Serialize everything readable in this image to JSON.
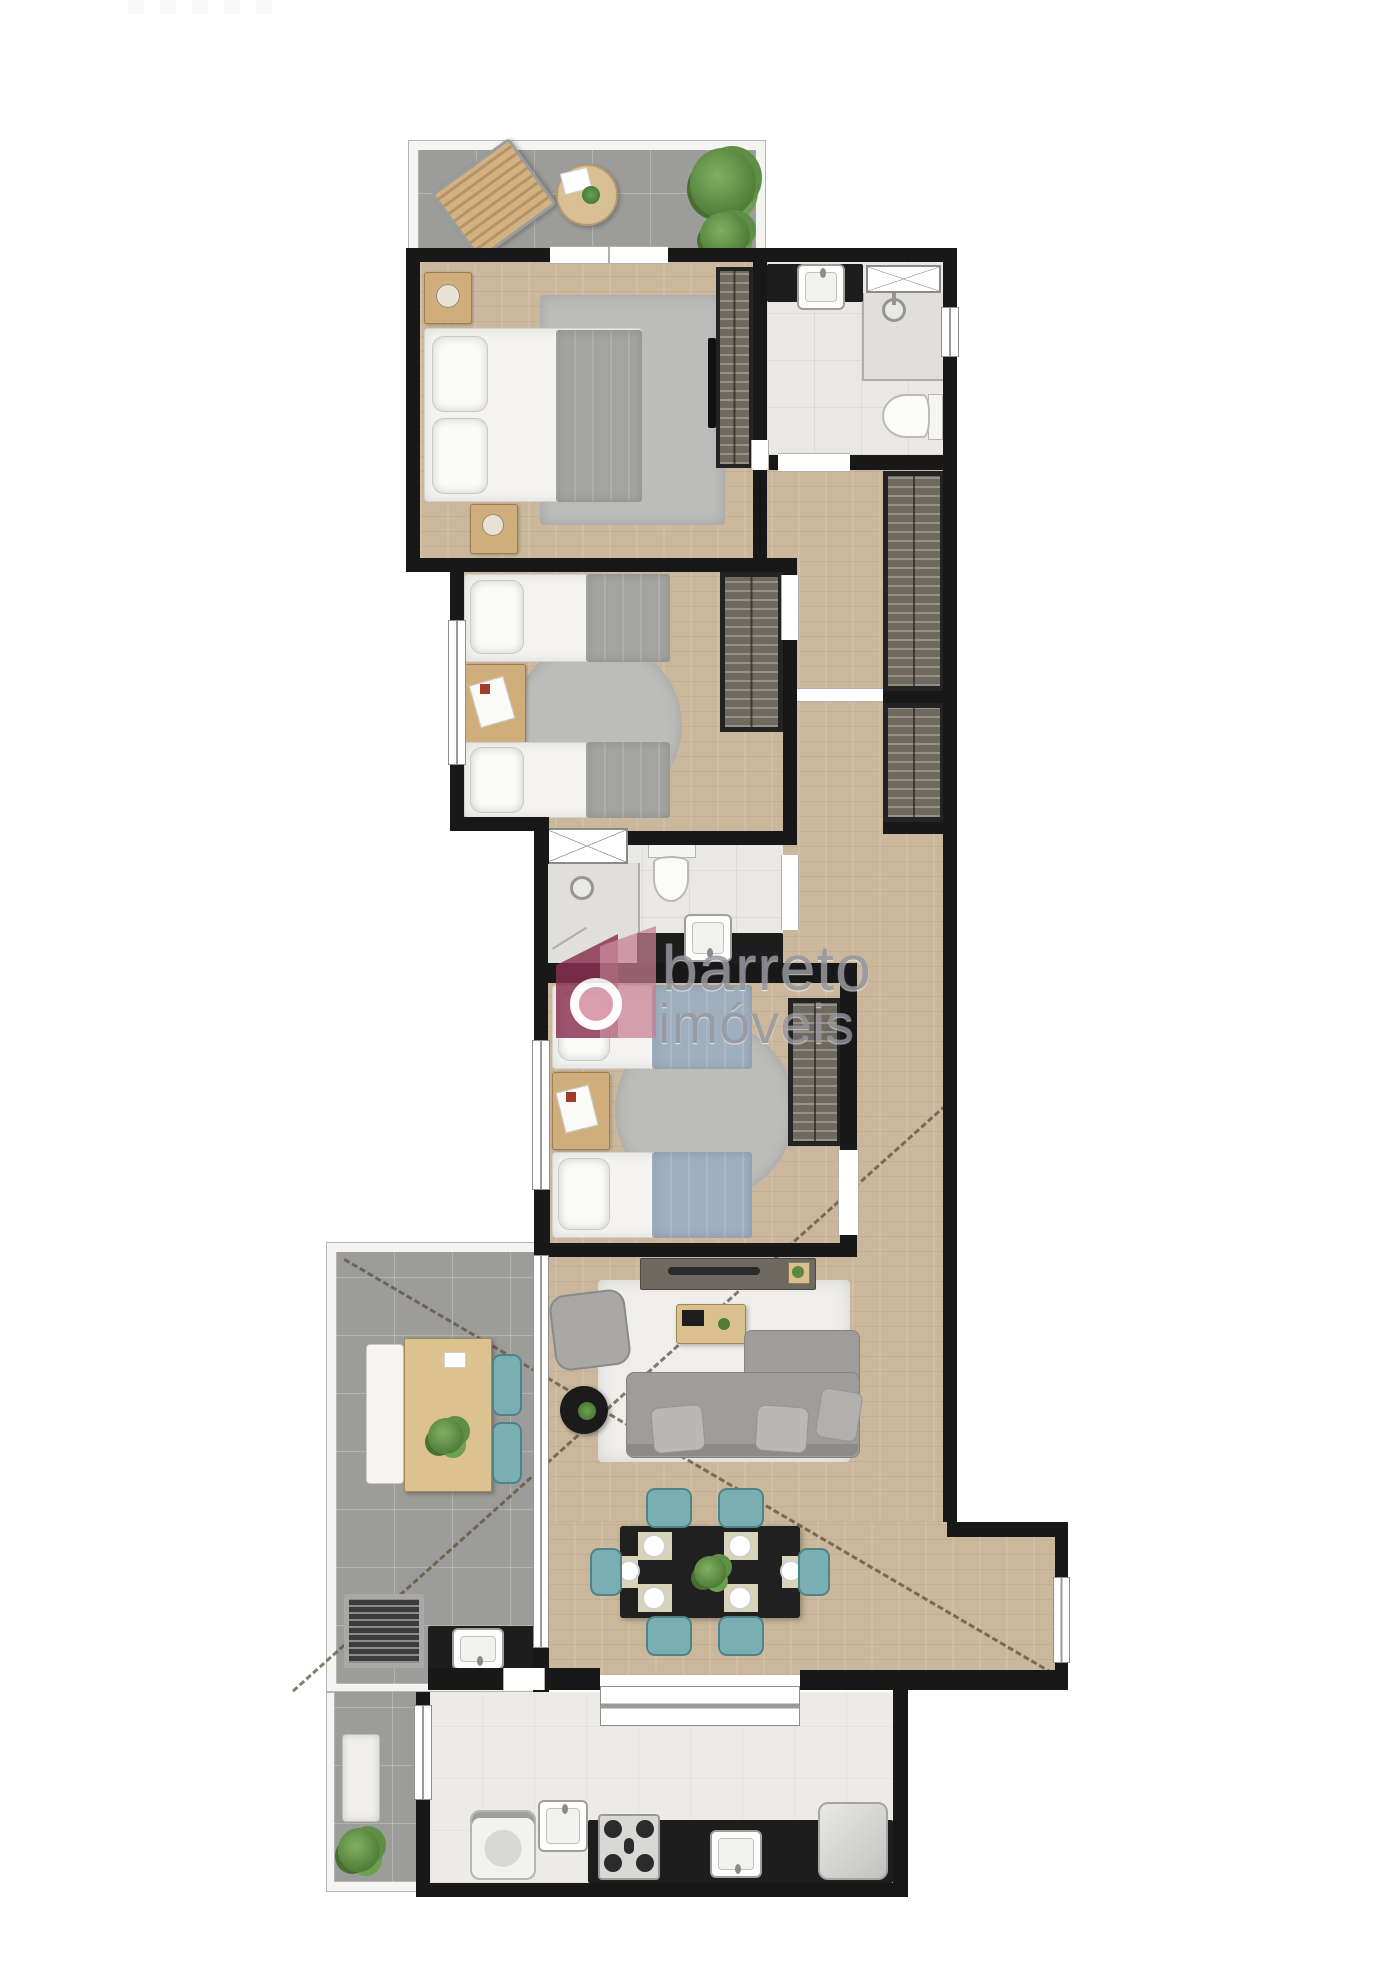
{
  "watermark": {
    "line1": "barreto",
    "line2": "imóveis"
  },
  "colors": {
    "wall": "#181818",
    "wood": "#cbb89c",
    "tile_gray": "#9c9c9a",
    "tile_bath": "#e9e8e4",
    "tile_kitchen": "#edebe7",
    "counter": "#1d1d1d",
    "wardrobe": "#6f6a60",
    "furniture_wood": "#cfae7c",
    "blanket_gray": "#a3a3a1",
    "blanket_blue": "#9fafbe",
    "teal_chair": "#79afb3",
    "sofa_gray": "#9e9d9b",
    "rug_white": "#efeeea",
    "rug_gray": "#bcbcba",
    "plant_green": "#4f7d38",
    "watermark_logo_dark": "#8a3150",
    "watermark_logo_light": "#c77d92",
    "watermark_text": "#97979f"
  }
}
